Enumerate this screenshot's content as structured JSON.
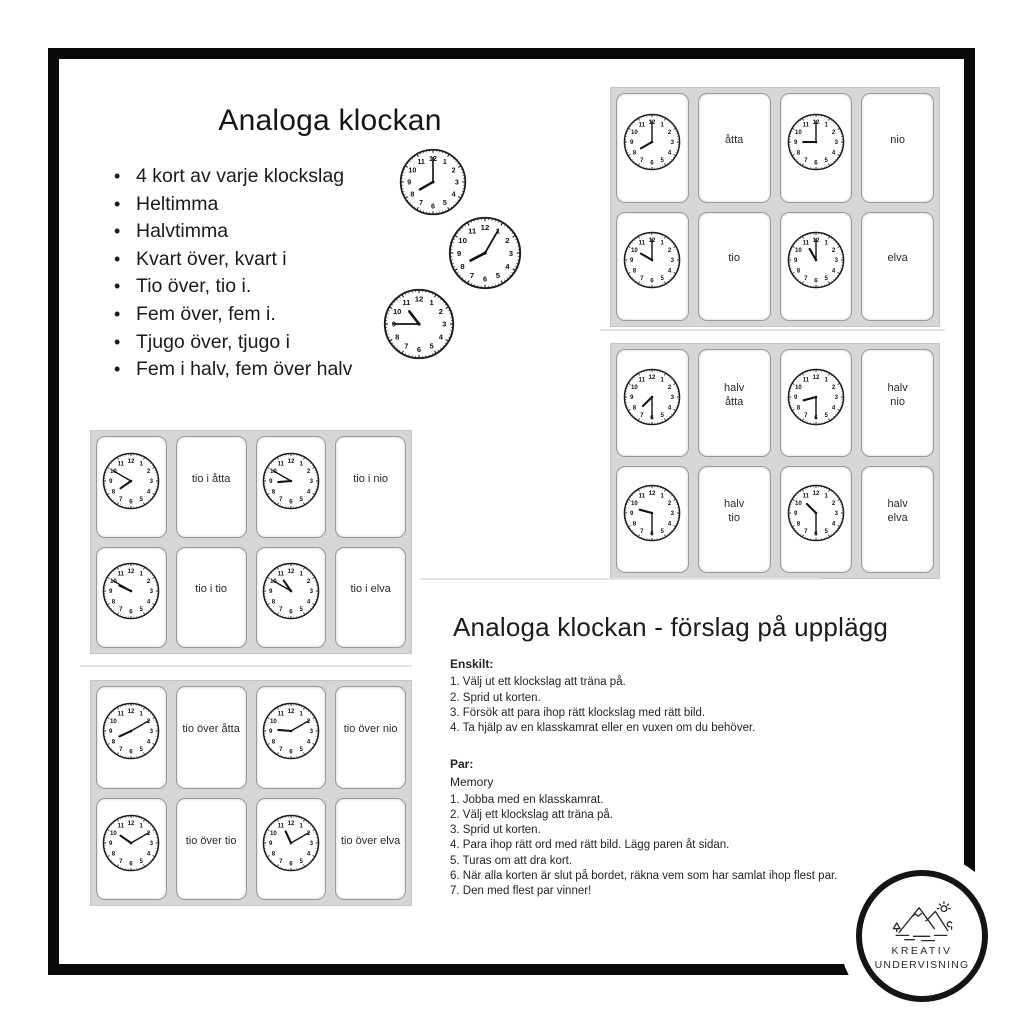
{
  "intro": {
    "title": "Analoga klockan",
    "bullets": [
      "4 kort av varje klockslag",
      "Heltimma",
      "Halvtimma",
      "Kvart över, kvart i",
      "Tio över, tio i.",
      "Fem över, fem i.",
      "Tjugo över, tjugo i",
      "Fem i halv, fem över halv"
    ],
    "demo_clocks": [
      "8:00",
      "8:05",
      "10:45"
    ]
  },
  "card_sheets": [
    {
      "name": "whole-hours",
      "cards": [
        {
          "type": "clock",
          "time": "8:00"
        },
        {
          "type": "text",
          "label": "åtta"
        },
        {
          "type": "clock",
          "time": "9:00"
        },
        {
          "type": "text",
          "label": "nio"
        },
        {
          "type": "clock",
          "time": "10:00"
        },
        {
          "type": "text",
          "label": "tio"
        },
        {
          "type": "clock",
          "time": "11:00"
        },
        {
          "type": "text",
          "label": "elva"
        }
      ]
    },
    {
      "name": "half-hours",
      "cards": [
        {
          "type": "clock",
          "time": "7:30"
        },
        {
          "type": "text",
          "label": "halv\nåtta"
        },
        {
          "type": "clock",
          "time": "8:30"
        },
        {
          "type": "text",
          "label": "halv\nnio"
        },
        {
          "type": "clock",
          "time": "9:30"
        },
        {
          "type": "text",
          "label": "halv\ntio"
        },
        {
          "type": "clock",
          "time": "10:30"
        },
        {
          "type": "text",
          "label": "halv\nelva"
        }
      ]
    },
    {
      "name": "ten-to",
      "cards": [
        {
          "type": "clock",
          "time": "7:50"
        },
        {
          "type": "text",
          "label": "tio i åtta"
        },
        {
          "type": "clock",
          "time": "8:50"
        },
        {
          "type": "text",
          "label": "tio i nio"
        },
        {
          "type": "clock",
          "time": "9:50"
        },
        {
          "type": "text",
          "label": "tio i tio"
        },
        {
          "type": "clock",
          "time": "10:50"
        },
        {
          "type": "text",
          "label": "tio i elva"
        }
      ]
    },
    {
      "name": "ten-past",
      "cards": [
        {
          "type": "clock",
          "time": "8:10"
        },
        {
          "type": "text",
          "label": "tio över åtta"
        },
        {
          "type": "clock",
          "time": "9:10"
        },
        {
          "type": "text",
          "label": "tio över nio"
        },
        {
          "type": "clock",
          "time": "10:10"
        },
        {
          "type": "text",
          "label": "tio över tio"
        },
        {
          "type": "clock",
          "time": "11:10"
        },
        {
          "type": "text",
          "label": "tio över elva"
        }
      ]
    }
  ],
  "instructions": {
    "title": "Analoga klockan - förslag på upplägg",
    "sections": [
      {
        "heading": "Enskilt:",
        "intro": "",
        "steps": [
          "1. Välj ut ett klockslag att träna på.",
          "2. Sprid ut korten.",
          "3. Försök att para ihop rätt klockslag med rätt bild.",
          "4. Ta hjälp av en klasskamrat eller en vuxen om du behöver."
        ]
      },
      {
        "heading": "Par:",
        "intro": "Memory",
        "steps": [
          "1. Jobba med en klasskamrat.",
          "2. Välj ett klockslag att träna på.",
          "3. Sprid ut korten.",
          "4. Para ihop rätt ord med rätt bild. Lägg paren åt sidan.",
          "5. Turas om att dra kort.",
          "6. När alla korten är slut på bordet, räkna vem som har samlat ihop flest par.",
          "7. Den med flest par vinner!"
        ]
      }
    ]
  },
  "logo": {
    "line1": "KREATIV",
    "line2": "UNDERVISNING"
  }
}
